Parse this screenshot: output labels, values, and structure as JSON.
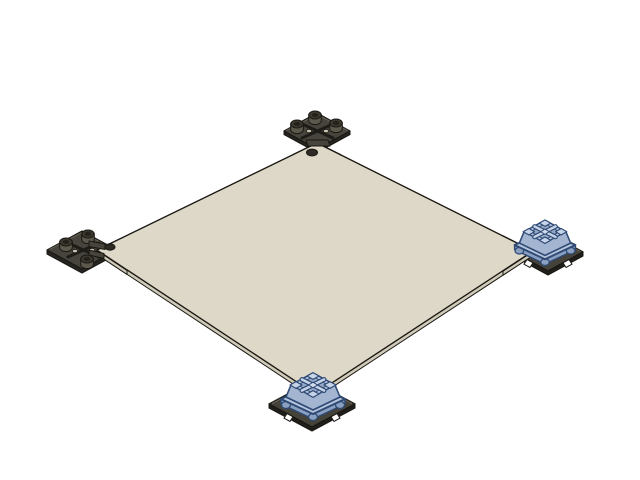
{
  "viewport": {
    "width": 640,
    "height": 480,
    "background": "#ffffff",
    "view_type": "isometric-3d-cad-view"
  },
  "colors": {
    "outline": "#1a1813",
    "plate_top": "#ded8c8",
    "plate_side": "#d0cab9",
    "bracket_top": "#46443c",
    "bracket_side": "#272521",
    "rib": "#1d1c16",
    "bracket_hole": "#c9c3b2",
    "boss_side": "#5c594c",
    "boss_top": "#3a382f",
    "boss_inner": "#23211a",
    "base_top": "#45423a",
    "base_side": "#211f1b",
    "base_hl": "#6b675b",
    "notch": "#ffffff",
    "plate_hole": "#2e2b25",
    "blue_outline": "#2e4a74",
    "flange_top": "#b5c4dc",
    "flange_side": "#8ba0c0",
    "body": "#a3b5d0",
    "top_face": "#b7c7df",
    "recess": "#97a9c6",
    "post": "#c7d3e7",
    "hub": "#d4ddee"
  },
  "parts": {
    "plate": {
      "label": "square-plate"
    },
    "bracket_rear": {
      "label": "corner-bracket"
    },
    "bracket_left": {
      "label": "corner-bracket"
    },
    "switch_right": {
      "label": "key-switch-on-corner-base"
    },
    "switch_front": {
      "label": "key-switch-on-corner-base"
    }
  }
}
